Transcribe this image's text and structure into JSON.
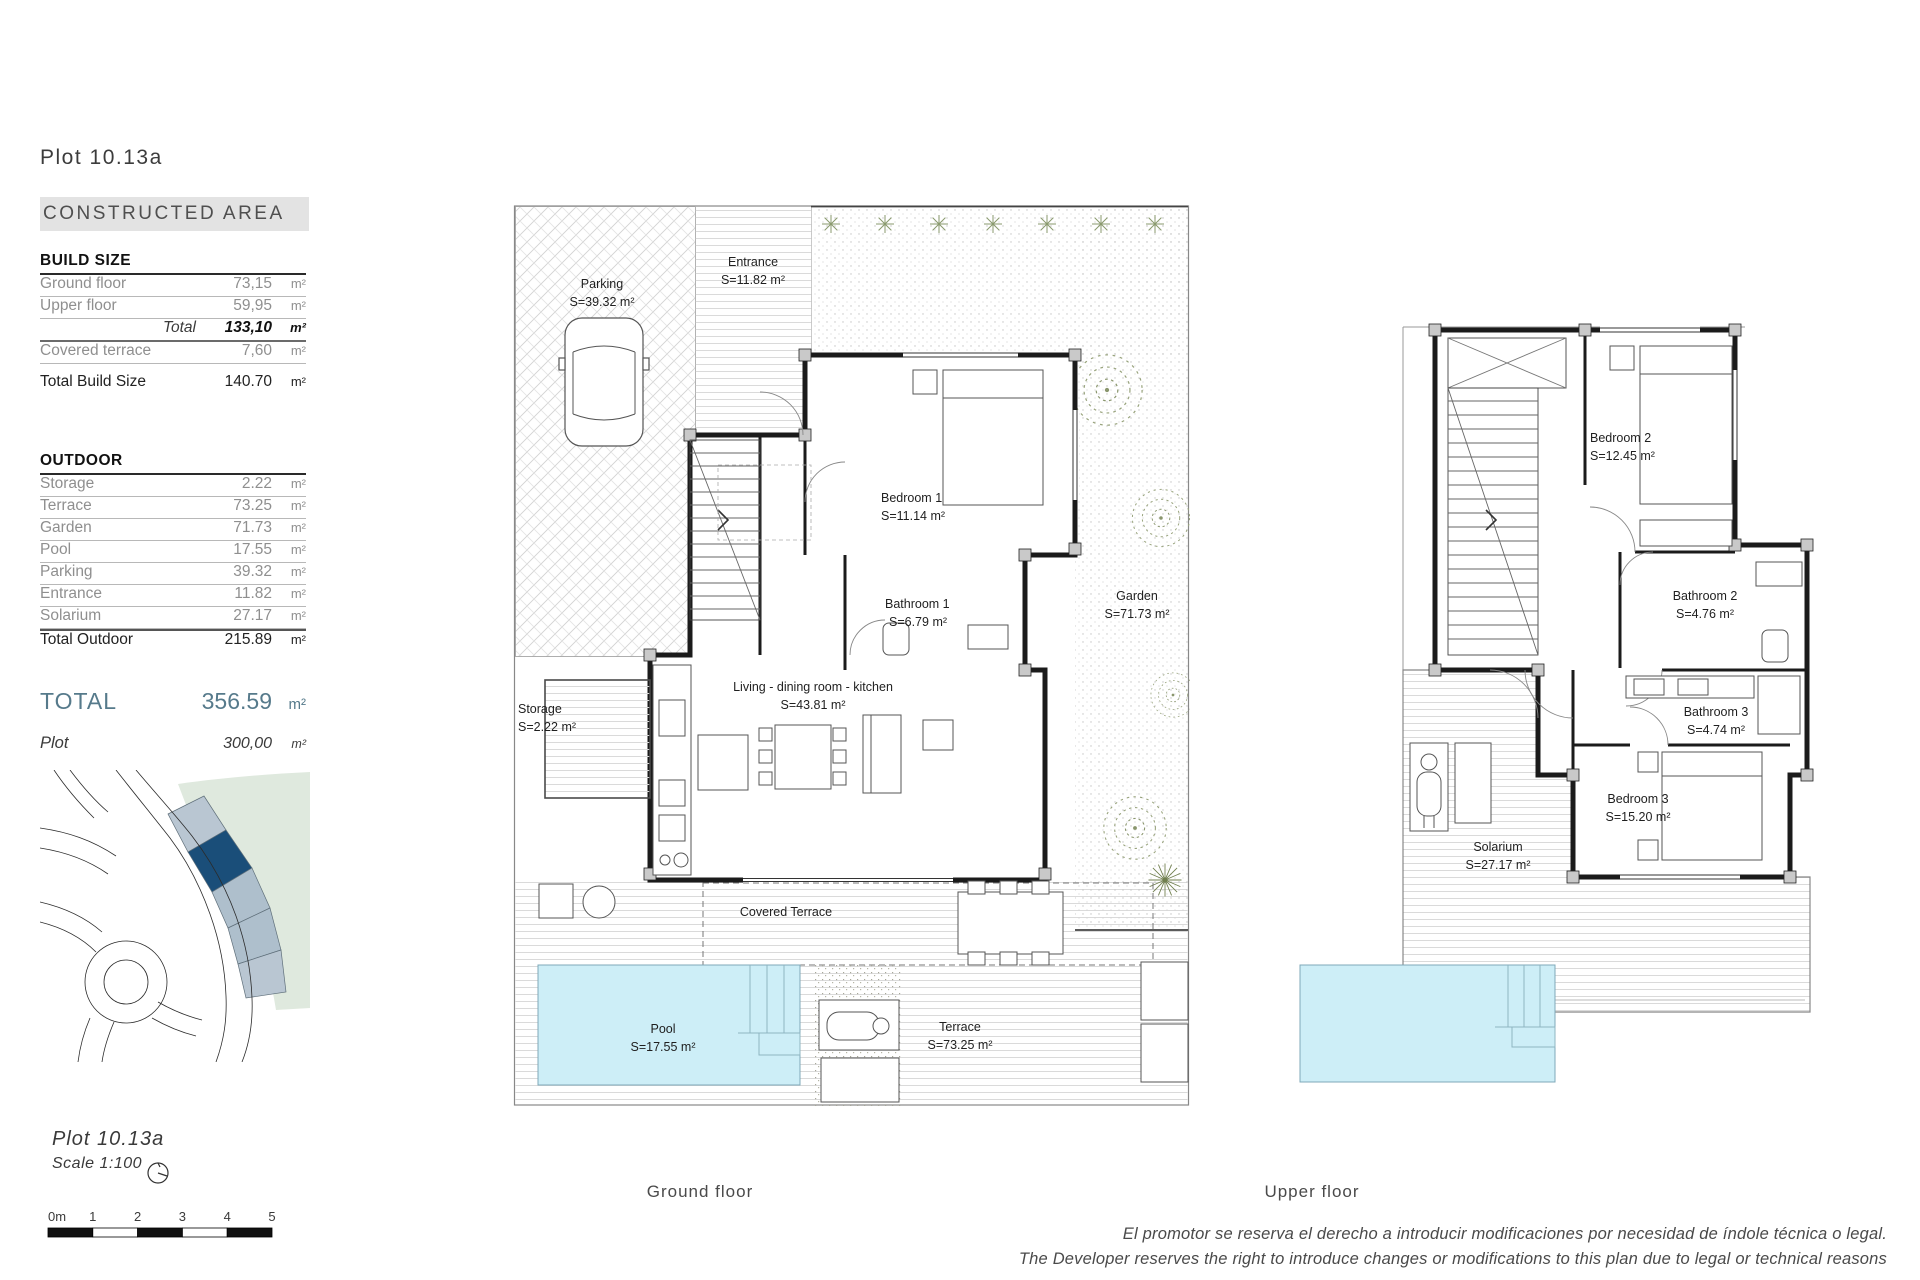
{
  "page": {
    "title": "Plot 10.13a",
    "footer": {
      "line_es": "El promotor se reserva el derecho a introducir modificaciones por necesidad de índole técnica o legal.",
      "line_en": "The Developer reserves the right to introduce changes or modifications to this plan due to legal or technical reasons"
    }
  },
  "summary": {
    "header": "CONSTRUCTED AREA",
    "build": {
      "title": "BUILD SIZE",
      "rows": [
        {
          "label": "Ground floor",
          "value": "73,15",
          "unit": "m²"
        },
        {
          "label": "Upper floor",
          "value": "59,95",
          "unit": "m²"
        }
      ],
      "total": {
        "label": "Total",
        "value": "133,10",
        "unit": "m²"
      },
      "covered": {
        "label": "Covered terrace",
        "value": "7,60",
        "unit": "m²"
      },
      "total_build": {
        "label": "Total Build Size",
        "value": "140.70",
        "unit": "m²"
      }
    },
    "outdoor": {
      "title": "OUTDOOR",
      "rows": [
        {
          "label": "Storage",
          "value": "2.22",
          "unit": "m²"
        },
        {
          "label": "Terrace",
          "value": "73.25",
          "unit": "m²"
        },
        {
          "label": "Garden",
          "value": "71.73",
          "unit": "m²"
        },
        {
          "label": "Pool",
          "value": "17.55",
          "unit": "m²"
        },
        {
          "label": "Parking",
          "value": "39.32",
          "unit": "m²"
        },
        {
          "label": "Entrance",
          "value": "11.82",
          "unit": "m²"
        },
        {
          "label": "Solarium",
          "value": "27.17",
          "unit": "m²"
        }
      ],
      "total": {
        "label": "Total Outdoor",
        "value": "215.89",
        "unit": "m²"
      }
    },
    "grand_total": {
      "label": "TOTAL",
      "value": "356.59",
      "unit": "m²"
    },
    "plot": {
      "label": "Plot",
      "value": "300,00",
      "unit": "m²"
    }
  },
  "site_note": {
    "plot": "Plot 10.13a",
    "scale": "Scale 1:100"
  },
  "scale_bar": {
    "labels": [
      "0m",
      "1",
      "2",
      "3",
      "4",
      "5"
    ]
  },
  "ground_floor": {
    "caption": "Ground floor",
    "labels": {
      "parking": {
        "name": "Parking",
        "area": "S=39.32 m²"
      },
      "entrance": {
        "name": "Entrance",
        "area": "S=11.82 m²"
      },
      "bedroom1": {
        "name": "Bedroom 1",
        "area": "S=11.14 m²"
      },
      "bathroom1": {
        "name": "Bathroom 1",
        "area": "S=6.79 m²"
      },
      "living": {
        "name": "Living - dining  room - kitchen",
        "area": "S=43.81 m²"
      },
      "garden": {
        "name": "Garden",
        "area": "S=71.73 m²"
      },
      "storage": {
        "name": "Storage",
        "area": "S=2.22 m²"
      },
      "covered_terrace": {
        "name": "Covered Terrace"
      },
      "pool": {
        "name": "Pool",
        "area": "S=17.55 m²"
      },
      "terrace": {
        "name": "Terrace",
        "area": "S=73.25 m²"
      }
    }
  },
  "upper_floor": {
    "caption": "Upper floor",
    "labels": {
      "bedroom2": {
        "name": "Bedroom 2",
        "area": "S=12.45 m²"
      },
      "bathroom2": {
        "name": "Bathroom 2",
        "area": "S=4.76 m²"
      },
      "bathroom3": {
        "name": "Bathroom 3",
        "area": "S=4.74 m²"
      },
      "bedroom3": {
        "name": "Bedroom 3",
        "area": "S=15.20 m²"
      },
      "solarium": {
        "name": "Solarium",
        "area": "S=27.17 m²"
      }
    }
  },
  "colors": {
    "accent_total": "#567a8b",
    "pool_fill": "#cdeef7",
    "map_green": "#dfe9de",
    "map_plot_selected": "#1a4e79",
    "map_plot_neighbor": "#aebfcc",
    "header_bg": "#e3e3e3"
  }
}
